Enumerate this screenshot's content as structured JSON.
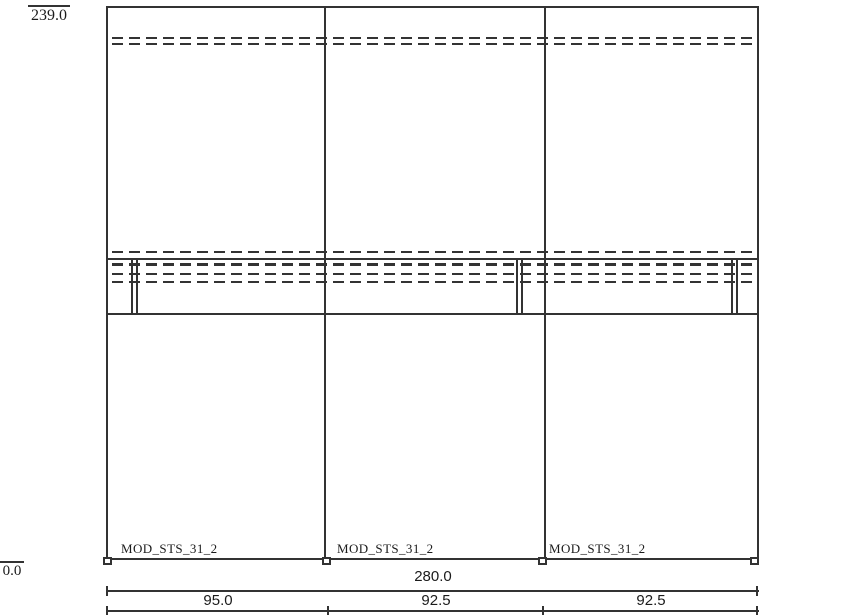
{
  "levels": {
    "top": "239.0",
    "bottom": "0.0"
  },
  "modules": [
    {
      "name": "MOD_STS_31_2",
      "width": "95.0"
    },
    {
      "name": "MOD_STS_31_2",
      "width": "92.5"
    },
    {
      "name": "MOD_STS_31_2",
      "width": "92.5"
    }
  ],
  "total_width": "280.0",
  "colors": {
    "line": "#333333",
    "background": "#ffffff",
    "text": "#1b1b1b"
  }
}
